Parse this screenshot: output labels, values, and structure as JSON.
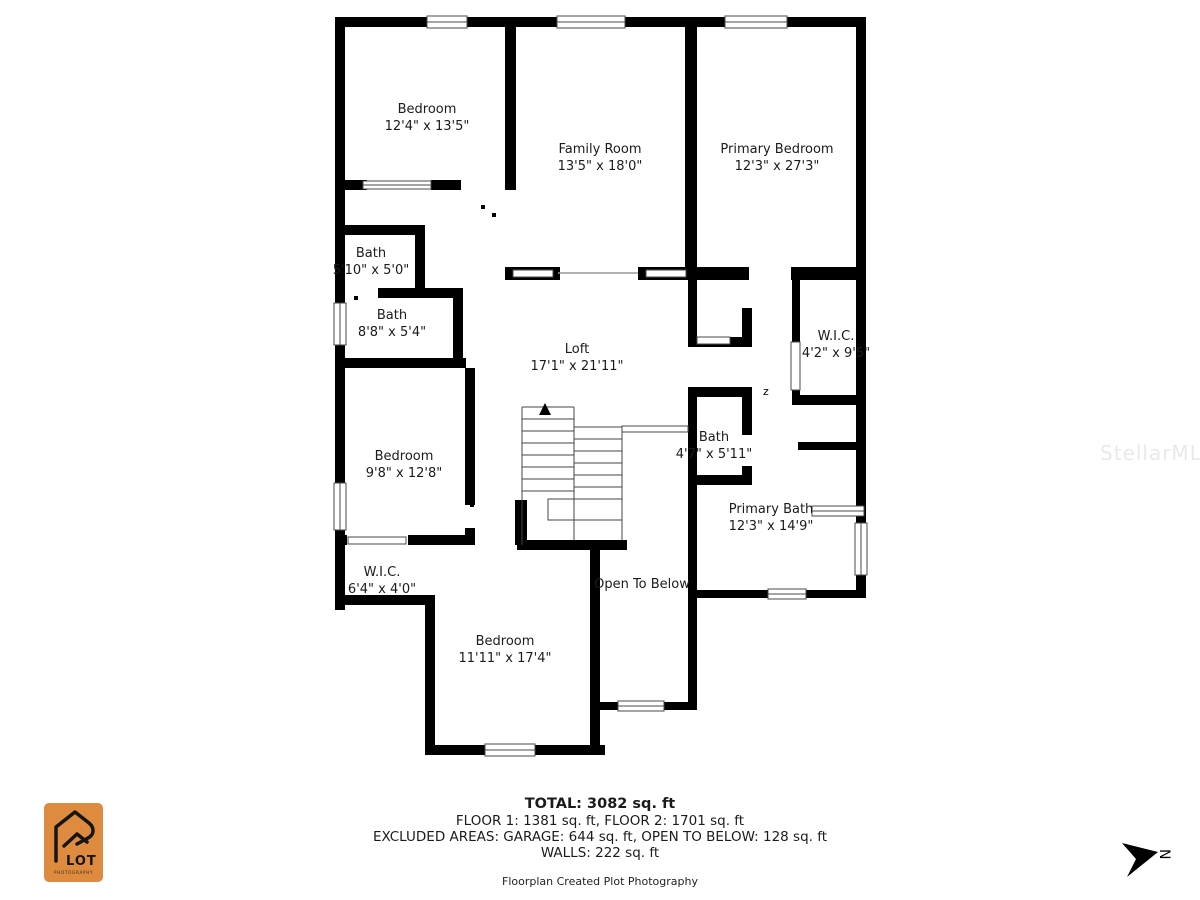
{
  "watermark": "StellarMLS",
  "compass": {
    "letter": "N"
  },
  "logo": {
    "name": "LOT",
    "sub": "PHOTOGRAPHY"
  },
  "rooms": [
    {
      "name": "Bedroom",
      "size": "12'4\" x 13'5\""
    },
    {
      "name": "Family Room",
      "size": "13'5\" x 18'0\""
    },
    {
      "name": "Primary Bedroom",
      "size": "12'3\" x 27'3\""
    },
    {
      "name": "Bath",
      "size": "5'10\" x 5'0\""
    },
    {
      "name": "Bath",
      "size": "8'8\" x 5'4\""
    },
    {
      "name": "Loft",
      "size": "17'1\" x 21'11\""
    },
    {
      "name": "W.I.C.",
      "size": "4'2\" x 9'5\""
    },
    {
      "name": "Bath",
      "size": "4'7\" x 5'11\""
    },
    {
      "name": "Bedroom",
      "size": "9'8\" x 12'8\""
    },
    {
      "name": "W.I.C.",
      "size": "6'4\" x 4'0\""
    },
    {
      "name": "Primary Bath",
      "size": "12'3\" x 14'9\""
    },
    {
      "name": "Bedroom",
      "size": "11'11\" x 17'4\""
    },
    {
      "name": "Open To Below",
      "size": ""
    }
  ],
  "summary": {
    "total": "TOTAL: 3082 sq. ft",
    "floors": "FLOOR 1: 1381 sq. ft, FLOOR 2: 1701 sq. ft",
    "excluded": "EXCLUDED AREAS: GARAGE: 644 sq. ft, OPEN TO BELOW: 128 sq. ft",
    "walls": "WALLS: 222 sq. ft",
    "credit": "Floorplan Created Plot Photography"
  }
}
